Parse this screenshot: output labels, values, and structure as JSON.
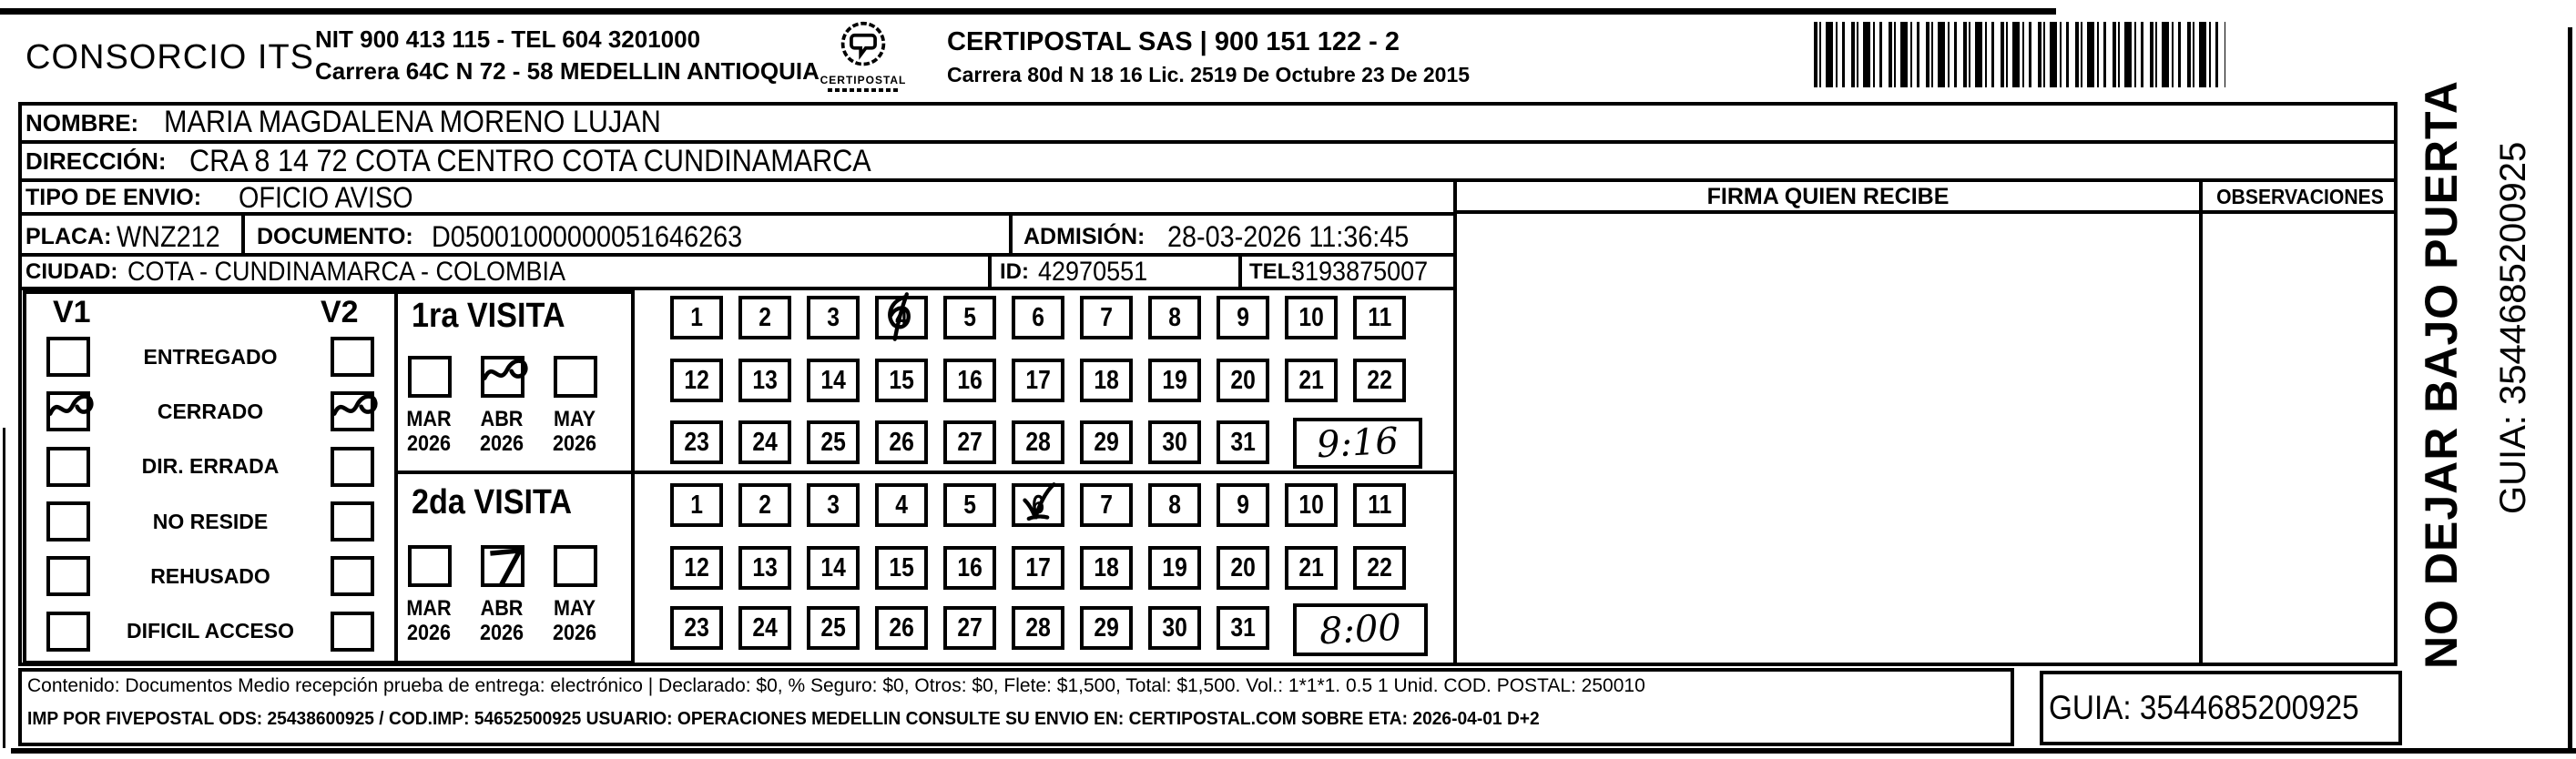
{
  "header": {
    "company": "CONSORCIO ITS",
    "company_info_line1": "NIT 900 413 115 - TEL 604 3201000",
    "company_info_line2": "Carrera 64C N 72 - 58 MEDELLIN ANTIOQUIA",
    "logo_text": "CERTIPOSTAL",
    "certipostal_line1": "CERTIPOSTAL SAS | 900 151 122 - 2",
    "certipostal_line2": "Carrera 80d N 18 16  Lic. 2519 De Octubre 23 De 2015"
  },
  "recipient": {
    "nombre_label": "NOMBRE:",
    "nombre": "MARIA MAGDALENA MORENO LUJAN",
    "direccion_label": "DIRECCIÓN:",
    "direccion": "CRA 8  14 72 COTA CENTRO COTA CUNDINAMARCA",
    "tipo_label": "TIPO DE ENVIO:",
    "tipo": "OFICIO AVISO",
    "placa_label": "PLACA:",
    "placa": "WNZ212",
    "documento_label": "DOCUMENTO:",
    "documento": "D05001000000051646263",
    "admision_label": "ADMISIÓN:",
    "admision": "28-03-2026 11:36:45",
    "ciudad_label": "CIUDAD:",
    "ciudad": "COTA - CUNDINAMARCA - COLOMBIA",
    "id_label": "ID:",
    "id": "42970551",
    "tel_label": "TEL:",
    "tel": "3193875007"
  },
  "columns": {
    "firma": "FIRMA QUIEN RECIBE",
    "observaciones": "OBSERVACIONES"
  },
  "status": {
    "v1_label": "V1",
    "v2_label": "V2",
    "options": [
      {
        "label": "ENTREGADO",
        "v1": false,
        "v2": false
      },
      {
        "label": "CERRADO",
        "v1": true,
        "v2": true
      },
      {
        "label": "DIR. ERRADA",
        "v1": false,
        "v2": false
      },
      {
        "label": "NO RESIDE",
        "v1": false,
        "v2": false
      },
      {
        "label": "REHUSADO",
        "v1": false,
        "v2": false
      },
      {
        "label": "DIFICIL ACCESO",
        "v1": false,
        "v2": false
      }
    ]
  },
  "visits": [
    {
      "title": "1ra VISITA",
      "months": [
        {
          "label": "MAR",
          "year": "2026",
          "checked": false
        },
        {
          "label": "ABR",
          "year": "2026",
          "checked": true
        },
        {
          "label": "MAY",
          "year": "2026",
          "checked": false
        }
      ],
      "day_count": 31,
      "marked_day": 4,
      "time": "9:16"
    },
    {
      "title": "2da VISITA",
      "months": [
        {
          "label": "MAR",
          "year": "2026",
          "checked": false
        },
        {
          "label": "ABR",
          "year": "2026",
          "checked": true
        },
        {
          "label": "MAY",
          "year": "2026",
          "checked": false
        }
      ],
      "day_count": 31,
      "marked_day": 6,
      "time": "8:00"
    }
  ],
  "side": {
    "warning": "NO DEJAR BAJO PUERTA",
    "guia": "GUIA: 3544685200925"
  },
  "footer": {
    "line1": "Contenido: Documentos Medio recepción prueba de entrega: electrónico | Declarado: $0, % Seguro: $0, Otros: $0, Flete: $1,500, Total: $1,500. Vol.: 1*1*1. 0.5  1 Unid. COD. POSTAL: 250010",
    "line2": "IMP POR FIVEPOSTAL ODS: 25438600925 / COD.IMP: 54652500925 USUARIO: OPERACIONES MEDELLIN CONSULTE SU ENVIO EN: CERTIPOSTAL.COM SOBRE ETA: 2026-04-01 D+2",
    "guia_box": "GUIA: 3544685200925"
  }
}
